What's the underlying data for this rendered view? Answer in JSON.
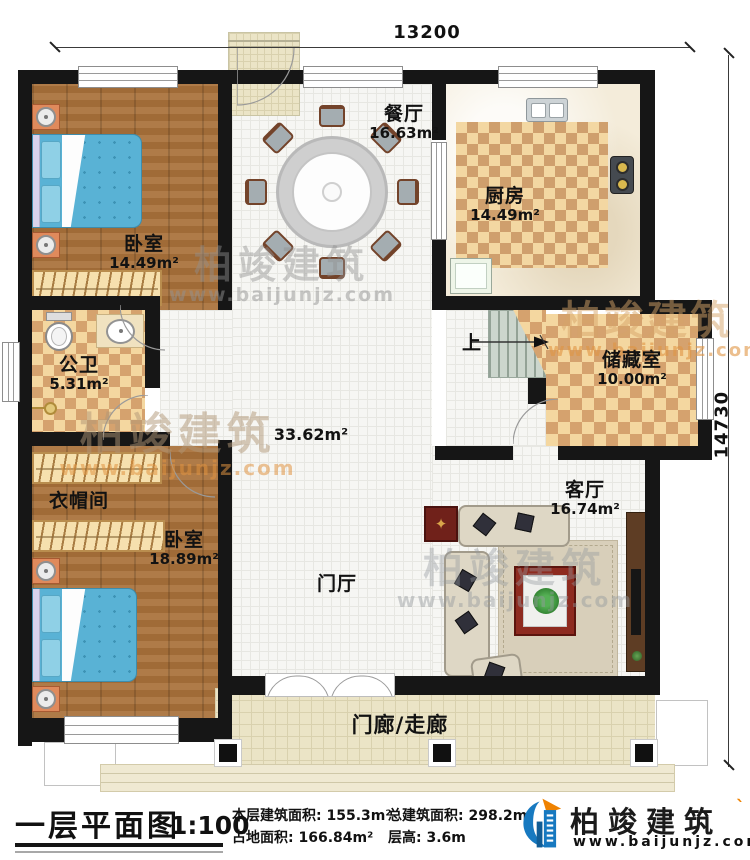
{
  "plan": {
    "dimensions": {
      "top": "13200",
      "right": "14730"
    },
    "stairs": {
      "up_label": "上"
    },
    "rooms": {
      "dining": {
        "name": "餐厅",
        "area": "16.63m²"
      },
      "kitchen": {
        "name": "厨房",
        "area": "14.49m²"
      },
      "bedroom_top": {
        "name": "卧室",
        "area": "14.49m²"
      },
      "bathroom": {
        "name": "公卫",
        "area": "5.31m²"
      },
      "storage": {
        "name": "储藏室",
        "area": "10.00m²"
      },
      "hall": {
        "area": "33.62m²"
      },
      "cloakroom": {
        "name": "衣帽间"
      },
      "bedroom_bottom": {
        "name": "卧室",
        "area": "18.89m²"
      },
      "foyer": {
        "name": "门厅"
      },
      "living": {
        "name": "客厅",
        "area": "16.74m²"
      },
      "porch": {
        "name": "门廊/走廊"
      }
    }
  },
  "watermark": {
    "name": "柏竣建筑",
    "url": "www.baijunjz.com"
  },
  "footer": {
    "title": "一层平面图",
    "scale": "1:100",
    "stats": [
      {
        "label": "本层建筑面积:",
        "value": "155.3m²"
      },
      {
        "label": "占地面积:",
        "value": "166.84m²"
      },
      {
        "label": "总建筑面积:",
        "value": "298.2m²"
      },
      {
        "label": "层高:",
        "value": "3.6m"
      }
    ],
    "logo": {
      "name": "柏竣建筑",
      "url": "www.baijunjz.com"
    }
  }
}
